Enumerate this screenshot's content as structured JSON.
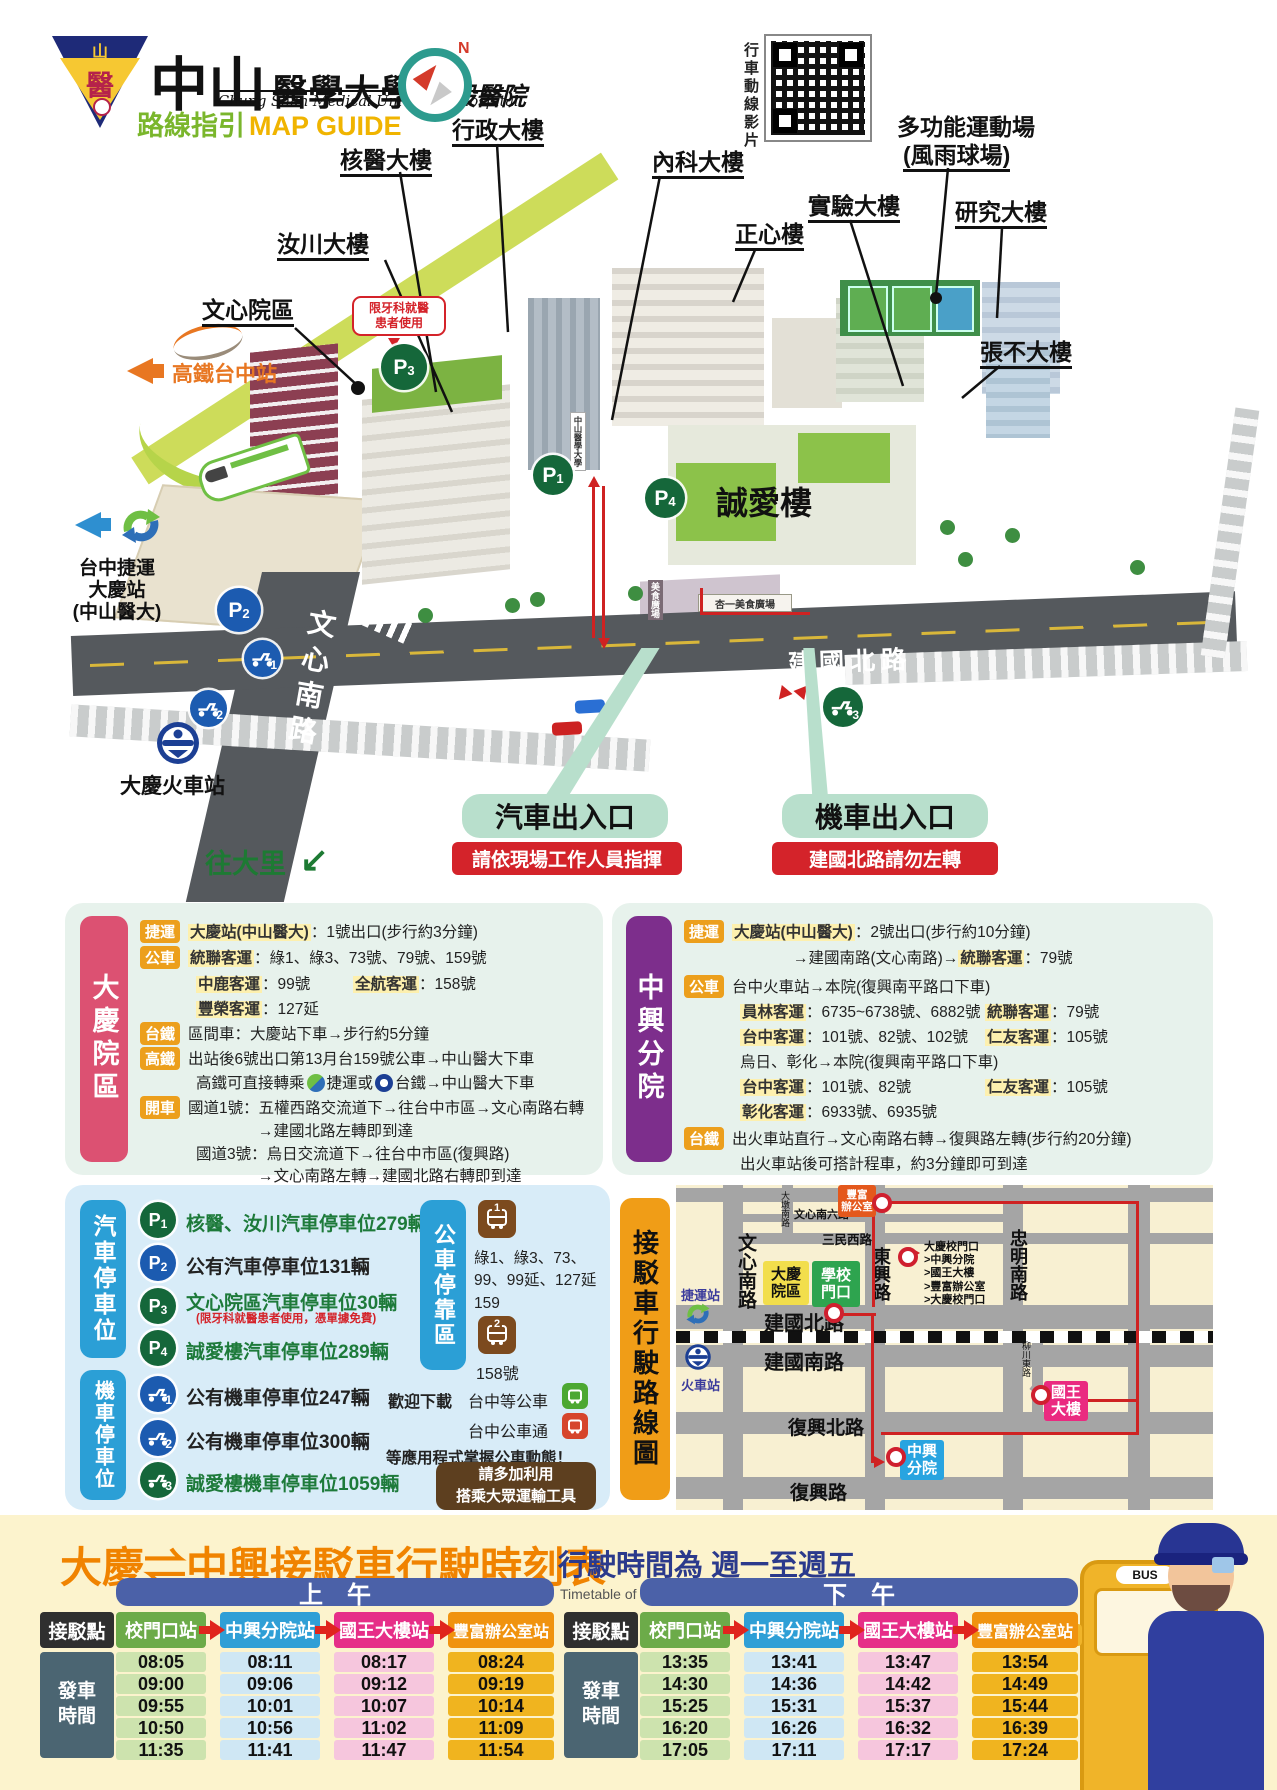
{
  "brand": {
    "emblem_top": "山中",
    "emblem_glyph": "醫",
    "name_big": "中山",
    "name_mid": "醫學大學",
    "name_suffix": "附設醫院",
    "name_en": "Chung Shan Medical University Hospital",
    "guide_zh": "路線指引",
    "guide_en": "MAP GUIDE",
    "compass_n": "N",
    "qr_caption": "行車動線影片"
  },
  "map": {
    "labels": {
      "nuclear": "核醫大樓",
      "admin": "行政大樓",
      "internal": "內科大樓",
      "zhengxin": "正心樓",
      "lab": "實驗大樓",
      "research": "研究大樓",
      "sports1": "多功能運動場",
      "sports2": "(風雨球場)",
      "zhangbu": "張不大樓",
      "ruchuan": "汝川大樓",
      "wenxin": "文心院區",
      "chengai": "誠愛樓",
      "campus_sign": "中山醫學大學",
      "food_court": "杏一美食廣場",
      "food_court2": "美食廣場"
    },
    "dental_note": "限牙科就醫\n患者使用",
    "gates": {
      "car": "汽車出入口",
      "car_note": "請依現場工作人員指揮",
      "moto": "機車出入口",
      "moto_note": "建國北路請勿左轉"
    },
    "transit": {
      "hsr": "高鐵台中站",
      "mrt": "台中捷運\n大慶站\n(中山醫大)",
      "tra": "大慶火車站",
      "to_dali": "往大里",
      "to_dali_arrow": "↙"
    },
    "roads": {
      "wenxin_s": "文心南路",
      "jianguo_n": "建國北路"
    },
    "badges": {
      "p": "P",
      "n1": "1",
      "n2": "2",
      "n3": "3",
      "n4": "4",
      "m1": "1",
      "m2": "2",
      "m3": "3"
    }
  },
  "daqing": {
    "side": "大慶院區",
    "tag_mrt": "捷運",
    "tag_bus": "公車",
    "tag_tra": "台鐵",
    "tag_hsr": "高鐵",
    "tag_drive": "開車",
    "mrt_hl": "大慶站(中山醫大)",
    "mrt_rest": "：1號出口(步行約3分鐘)",
    "bus1_hl": "統聯客運",
    "bus1_rest": "：綠1、綠3、73號、79號、159號",
    "bus2a_hl": "中鹿客運",
    "bus2a_rest": "：99號",
    "bus2b_hl": "全航客運",
    "bus2b_rest": "：158號",
    "bus3_hl": "豐榮客運",
    "bus3_rest": "：127延",
    "tra_line": "區間車：大慶站下車→步行約5分鐘",
    "hsr_line1": "出站後6號出口第13月台159號公車→中山醫大下車",
    "hsr_line2a": "高鐵可直接轉乘",
    "hsr_line2b": "捷運或",
    "hsr_line2c": "台鐵→中山醫大下車",
    "drive1": "國道1號：五權西路交流道下→往台中市區→文心南路右轉",
    "drive1b": "→建國北路左轉即到達",
    "drive2": "國道3號：烏日交流道下→往台中市區(復興路)",
    "drive2b": "→文心南路左轉→建國北路右轉即到達"
  },
  "zhongxing": {
    "side": "中興分院",
    "mrt_hl": "大慶站(中山醫大)",
    "mrt_rest": "：2號出口(步行約10分鐘)",
    "mrt2a": "→建國南路(文心南路)→",
    "mrt2_hl": "統聯客運",
    "mrt2b": "：79號",
    "bus1": "台中火車站→本院(復興南平路口下車)",
    "bus2a_hl": "員林客運",
    "bus2a_rest": "：6735~6738號、6882號",
    "bus2b_hl": "統聯客運",
    "bus2b_rest": "：79號",
    "bus3a_hl": "台中客運",
    "bus3a_rest": "：101號、82號、102號",
    "bus3b_hl": "仁友客運",
    "bus3b_rest": "：105號",
    "bus4": "烏日、彰化→本院(復興南平路口下車)",
    "bus5a_hl": "台中客運",
    "bus5a_rest": "：101號、82號",
    "bus5b_hl": "仁友客運",
    "bus5b_rest": "：105號",
    "bus6_hl": "彰化客運",
    "bus6_rest": "：6933號、6935號",
    "tra1": "出火車站直行→文心南路右轉→復興路左轉(步行約20分鐘)",
    "tra2": "出火車站後可搭計程車，約3分鐘即可到達"
  },
  "parking": {
    "car_side": "汽車停車位",
    "moto_side": "機車停車位",
    "car1": "核醫、汝川汽車停車位279輛",
    "car2": "公有汽車停車位131輛",
    "car3": "文心院區汽車停車位30輛",
    "car3_note": "(限牙科就醫患者使用，憑單據免費)",
    "car4": "誠愛樓汽車停車位289輛",
    "moto1": "公有機車停車位247輛",
    "moto2": "公有機車停車位300輛",
    "moto3": "誠愛樓機車停車位1059輛"
  },
  "bus_zone": {
    "side": "公車停靠區",
    "stop1_num": "1",
    "stop1_routes": "綠1、綠3、73、\n99、99延、127延\n159",
    "stop2_num": "2",
    "stop2_routes": "158號",
    "download": "歡迎下載",
    "app1": "台中等公車",
    "app2": "台中公車通",
    "apps_note": "等應用程式掌握公車動態！",
    "cta": "請多加利用\n搭乘大眾運輸工具"
  },
  "route_map": {
    "side": "接駁車行駛路線圖",
    "roads": {
      "wenxin_s": "文心南路",
      "dadun_s": "大墩南路",
      "wenxin6": "文心南六路",
      "sanmin_w": "三民西路",
      "dongxing": "東興路",
      "zhongming_s": "忠明南路",
      "jianguo_n": "建國北路",
      "jianguo_s": "建國南路",
      "fuxing_n": "復興北路",
      "fuxing": "復興路",
      "liuchuan_e": "柳川東路"
    },
    "mrt_station": "捷運站",
    "train_station": "火車站",
    "stops": {
      "fengfu": "豐富\n辦公室",
      "daqing": "大慶\n院區",
      "school": "學校\n門口",
      "king": "國王\n大樓",
      "zhongxing": "中興\n分院"
    },
    "legend": "大慶校門口\n>中興分院\n>國王大樓\n>豐富辦公室\n>大慶校門口"
  },
  "timetable": {
    "title": "大慶⇌中興接駁車行駛時刻表",
    "subtitle": "行駛時間為  週一至週五",
    "subtitle_en": "Timetable of Shuttle Bus：Monday to Friday",
    "bus_sign": "BUS",
    "corner": "接駁點",
    "row_label": "發車\n時間",
    "am": "上　午",
    "pm": "下　午",
    "stations": [
      "校門口站",
      "中興分院站",
      "國王大樓站",
      "豐富辦公室站"
    ],
    "morning": [
      [
        "08:05",
        "08:11",
        "08:17",
        "08:24"
      ],
      [
        "09:00",
        "09:06",
        "09:12",
        "09:19"
      ],
      [
        "09:55",
        "10:01",
        "10:07",
        "10:14"
      ],
      [
        "10:50",
        "10:56",
        "11:02",
        "11:09"
      ],
      [
        "11:35",
        "11:41",
        "11:47",
        "11:54"
      ]
    ],
    "afternoon": [
      [
        "13:35",
        "13:41",
        "13:47",
        "13:54"
      ],
      [
        "14:30",
        "14:36",
        "14:42",
        "14:49"
      ],
      [
        "15:25",
        "15:31",
        "15:37",
        "15:44"
      ],
      [
        "16:20",
        "16:26",
        "16:32",
        "16:39"
      ],
      [
        "17:05",
        "17:11",
        "17:17",
        "17:24"
      ]
    ]
  }
}
